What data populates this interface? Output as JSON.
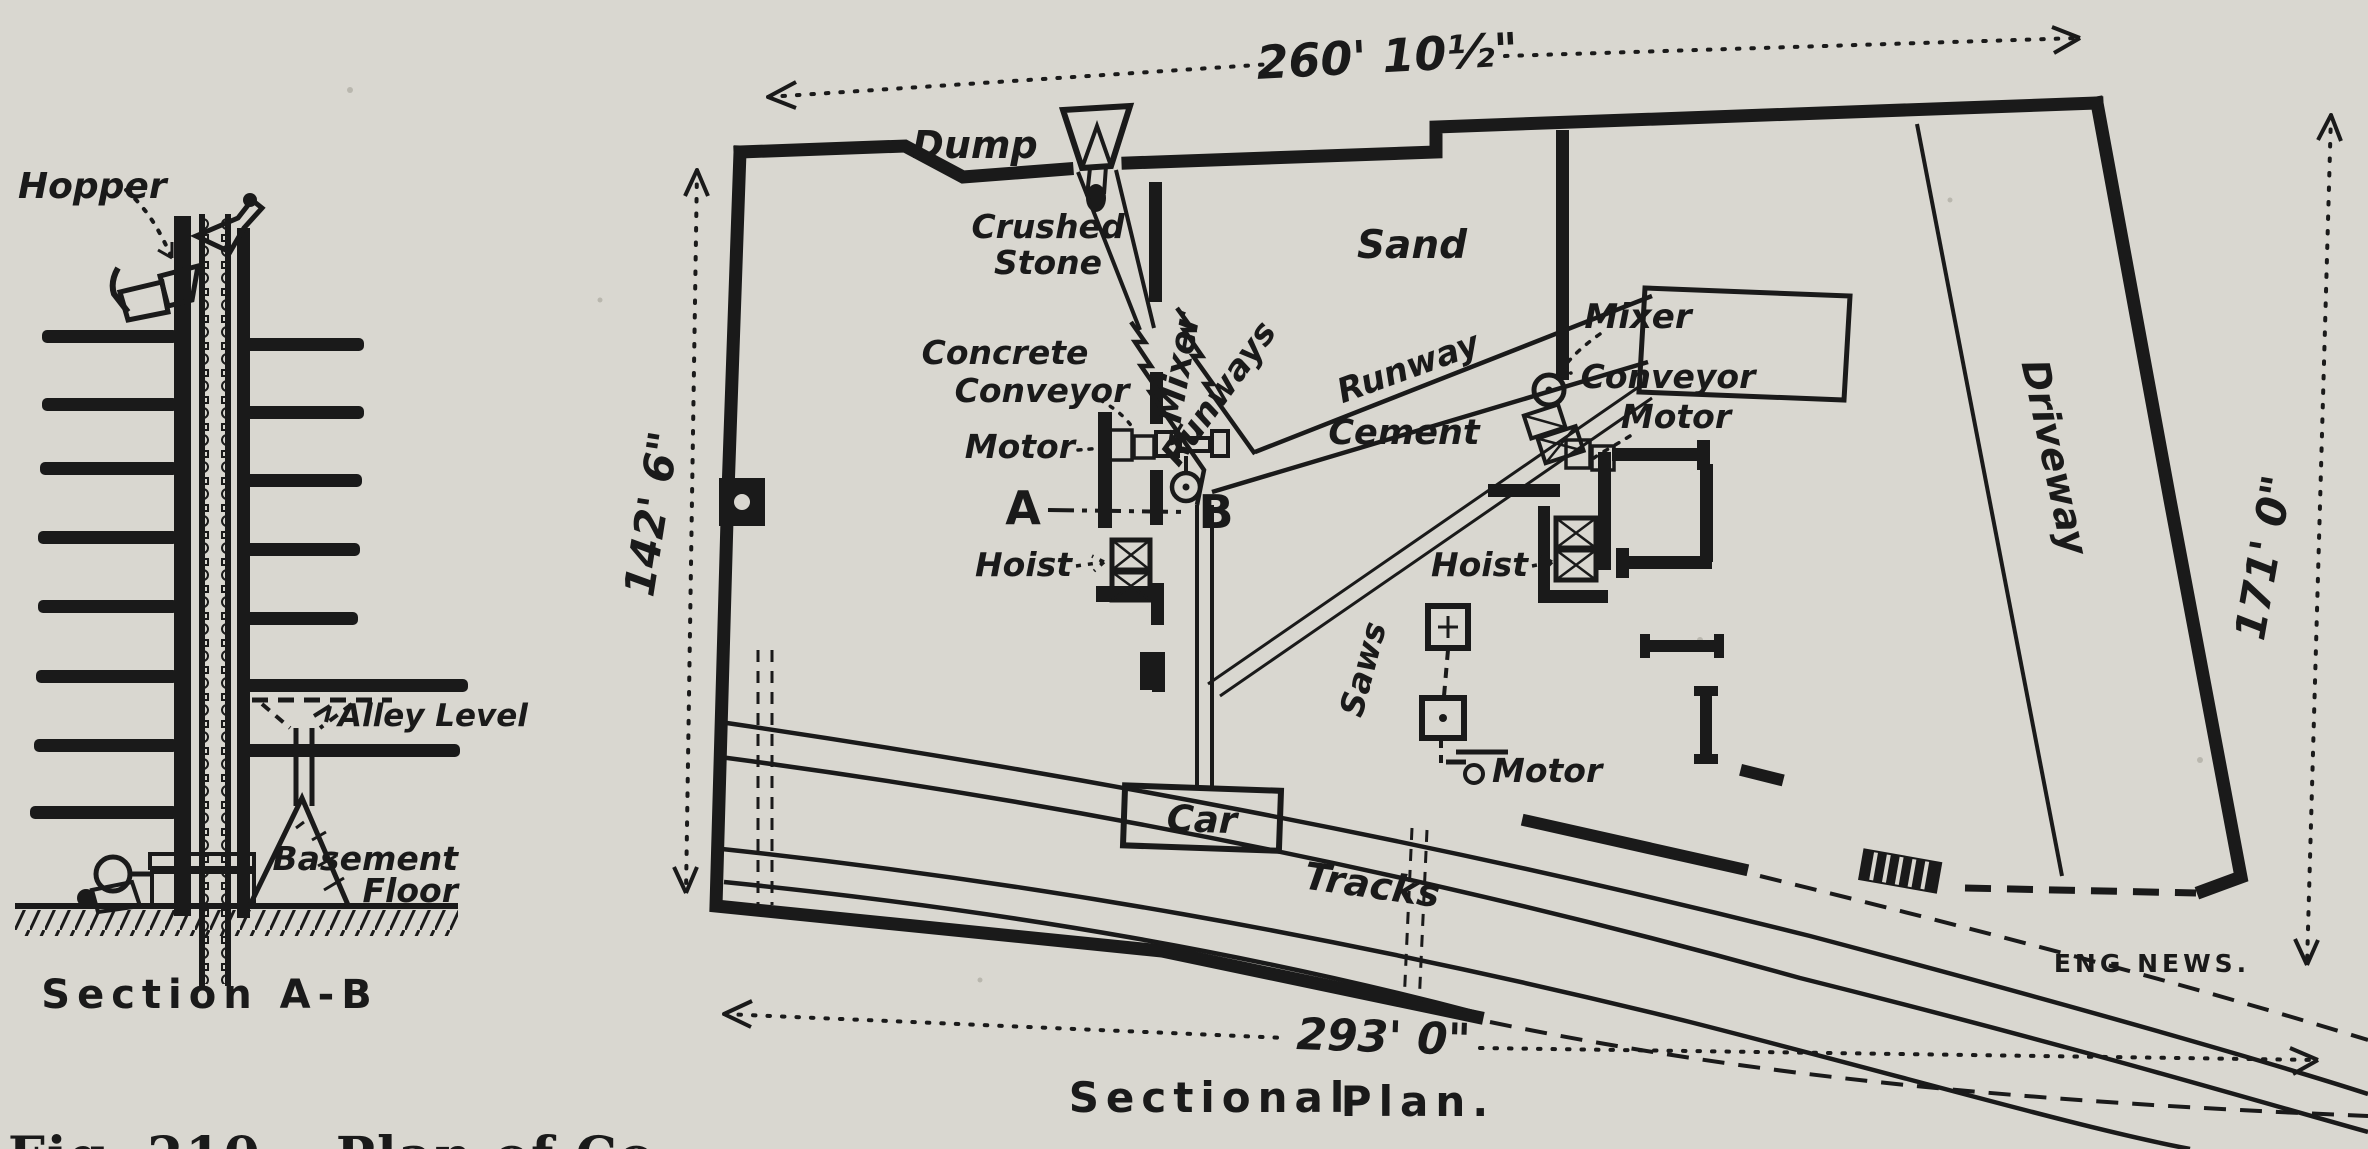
{
  "figure": {
    "caption_cropped": "Fig. 210.—Plan of Co",
    "credit": "ENG NEWS.",
    "plan_title_1": "Sectional",
    "plan_title_2": "Plan."
  },
  "section_detail": {
    "title": "Section A-B",
    "labels": {
      "hopper": "Hopper",
      "alley_level": "Alley Level",
      "basement_line1": "Basement",
      "basement_line2": "Floor"
    }
  },
  "plan": {
    "labels": {
      "dump": "Dump",
      "crushed1": "Crushed",
      "crushed2": "Stone",
      "sand": "Sand",
      "mixer_left": "Mixer",
      "concrete1": "Concrete",
      "concrete2": "Conveyor",
      "motor_left": "Motor",
      "point_a": "A",
      "point_b": "B",
      "hoist_left": "Hoist",
      "runways": "Runways",
      "runway": "Runway",
      "cement": "Cement",
      "mixer_right": "Mixer",
      "conveyor_right1": "Conveyor",
      "conveyor_right2": "Motor",
      "hoist_right": "Hoist",
      "saws": "Saws",
      "saws_motor": "Motor",
      "car": "Car",
      "tracks": "Tracks",
      "driveway": "Driveway"
    },
    "dimensions": {
      "top": "260' 10½\"",
      "left": "142' 6\"",
      "right": "171' 0\"",
      "bottom": "293' 0\""
    }
  },
  "colors": {
    "paper": "#d9d7d0",
    "ink": "#1a1a1a"
  }
}
